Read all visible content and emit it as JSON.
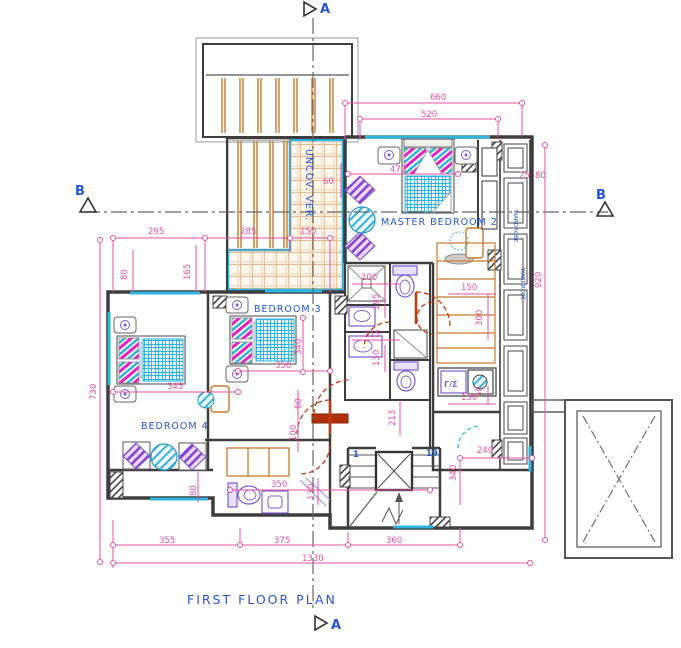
{
  "title": "FIRST FLOOR PLAN",
  "colors": {
    "dimension": "#ea4fa2",
    "label_blue": "#2456d6",
    "wall": "#3d3d3d",
    "wood": "#c8782a",
    "window_cyan": "#2fb3e0",
    "door_red": "#c53a0c",
    "fixture_purple": "#7b5cd6",
    "tile_tan": "#d9a87a",
    "pillow_magenta": "#e81ec8"
  },
  "section_markers": {
    "a_top": "A",
    "a_bottom": "A",
    "b_left": "B",
    "b_right": "B"
  },
  "rooms": [
    {
      "label": "MASTER BEDROOM 2",
      "x": 381,
      "y": 225,
      "r": 0
    },
    {
      "label": "BEDROOM 3",
      "x": 254,
      "y": 312,
      "r": 0
    },
    {
      "label": "BEDROOM 4",
      "x": 141,
      "y": 429,
      "r": 0
    },
    {
      "label": "UNCOV. VER.",
      "x": 306,
      "y": 149,
      "r": 90
    }
  ],
  "plan_labels": [
    {
      "t": "1",
      "x": 353,
      "y": 457,
      "c": "blue-sm"
    },
    {
      "t": "19",
      "x": 426,
      "y": 456,
      "c": "blue-sm"
    },
    {
      "t": "Γ/Σ",
      "x": 444,
      "y": 387,
      "c": "purple-sm"
    },
    {
      "t": "WARDROBE",
      "x": 514,
      "y": 210,
      "c": "tiny",
      "r": 90
    },
    {
      "t": "WARDROBE",
      "x": 521,
      "y": 268,
      "c": "tiny",
      "r": 90
    }
  ],
  "dimensions": [
    {
      "t": "660",
      "x": 430,
      "y": 100
    },
    {
      "t": "520",
      "x": 421,
      "y": 117
    },
    {
      "t": "470",
      "x": 390,
      "y": 172
    },
    {
      "t": "295",
      "x": 148,
      "y": 234
    },
    {
      "t": "285",
      "x": 240,
      "y": 234
    },
    {
      "t": "150",
      "x": 300,
      "y": 234
    },
    {
      "t": "60",
      "x": 323,
      "y": 184
    },
    {
      "t": "165",
      "x": 190,
      "y": 280,
      "r": -90
    },
    {
      "t": "80",
      "x": 127,
      "y": 280,
      "r": -90
    },
    {
      "t": "730",
      "x": 96,
      "y": 400,
      "r": -90
    },
    {
      "t": "345",
      "x": 167,
      "y": 389
    },
    {
      "t": "350",
      "x": 275,
      "y": 368
    },
    {
      "t": "340",
      "x": 301,
      "y": 355,
      "r": -90
    },
    {
      "t": "60",
      "x": 301,
      "y": 409,
      "r": -90
    },
    {
      "t": "100",
      "x": 296,
      "y": 441,
      "r": -90
    },
    {
      "t": "80",
      "x": 196,
      "y": 496,
      "r": -90
    },
    {
      "t": "350",
      "x": 271,
      "y": 487
    },
    {
      "t": "130",
      "x": 314,
      "y": 500,
      "r": -90
    },
    {
      "t": "200",
      "x": 361,
      "y": 280
    },
    {
      "t": "195",
      "x": 379,
      "y": 310,
      "r": -90
    },
    {
      "t": "215",
      "x": 364,
      "y": 337
    },
    {
      "t": "130",
      "x": 379,
      "y": 366,
      "r": -90
    },
    {
      "t": "213",
      "x": 395,
      "y": 426,
      "r": -90
    },
    {
      "t": "150",
      "x": 461,
      "y": 290
    },
    {
      "t": "300",
      "x": 482,
      "y": 326,
      "r": -90
    },
    {
      "t": "150",
      "x": 461,
      "y": 400
    },
    {
      "t": "50",
      "x": 482,
      "y": 397,
      "r": -90
    },
    {
      "t": "240",
      "x": 477,
      "y": 453
    },
    {
      "t": "340",
      "x": 456,
      "y": 481,
      "r": -90
    },
    {
      "t": "920",
      "x": 541,
      "y": 288,
      "r": -90
    },
    {
      "t": "355",
      "x": 159,
      "y": 543
    },
    {
      "t": "375",
      "x": 274,
      "y": 543
    },
    {
      "t": "360",
      "x": 386,
      "y": 543
    },
    {
      "t": "1330",
      "x": 302,
      "y": 561
    },
    {
      "t": "25",
      "x": 519,
      "y": 178
    },
    {
      "t": "80",
      "x": 535,
      "y": 178
    }
  ]
}
